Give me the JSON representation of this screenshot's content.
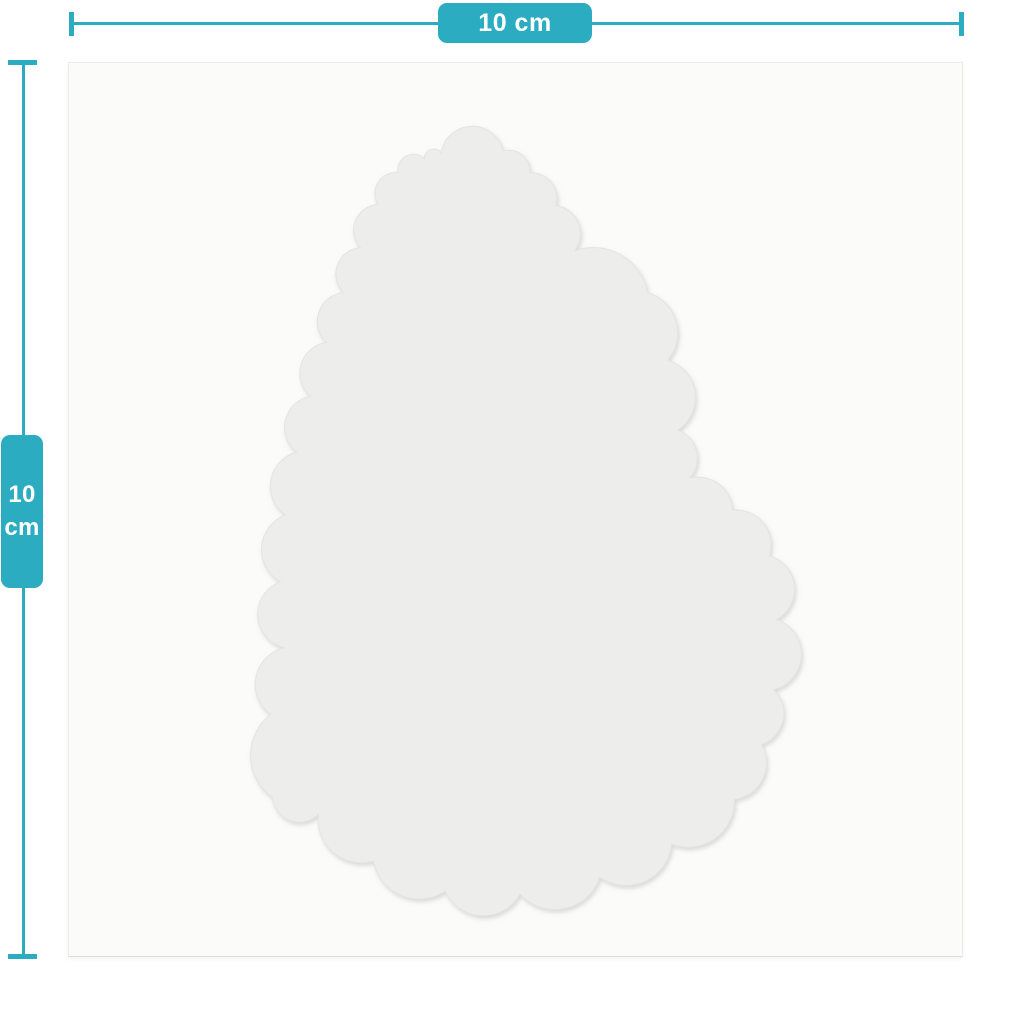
{
  "dimension_labels": {
    "horizontal": "10 cm",
    "vertical_value": "10",
    "vertical_unit": "cm"
  },
  "colors": {
    "accent": "#2bacc1",
    "canvas_background": "#fbfbfa",
    "sticker_fill": "#ededeb",
    "sticker_edge": "#e4e4e2",
    "label_text": "#ffffff"
  },
  "sticker_outline": {
    "bulge_default": 0.55,
    "points": [
      [
        373,
        90,
        0.5
      ],
      [
        435,
        88,
        0.51
      ],
      [
        462,
        110,
        0.62
      ],
      [
        488,
        143,
        0.62
      ],
      [
        507,
        188,
        0.58
      ],
      [
        580,
        230,
        0.66
      ],
      [
        600,
        298,
        0.6
      ],
      [
        610,
        368,
        0.55
      ],
      [
        622,
        416,
        0.6
      ],
      [
        665,
        448,
        0.65
      ],
      [
        702,
        494,
        0.6
      ],
      [
        709,
        558,
        0.54
      ],
      [
        706,
        628,
        0.52
      ],
      [
        694,
        683,
        0.58
      ],
      [
        667,
        738,
        0.6
      ],
      [
        604,
        783,
        0.6
      ],
      [
        532,
        816,
        0.58
      ],
      [
        452,
        833,
        0.58
      ],
      [
        377,
        830,
        0.56
      ],
      [
        305,
        800,
        0.6
      ],
      [
        250,
        753,
        0.6
      ],
      [
        204,
        736,
        0.55
      ],
      [
        202,
        653,
        0.62
      ],
      [
        216,
        586,
        0.55
      ],
      [
        212,
        520,
        0.52
      ],
      [
        217,
        453,
        0.55
      ],
      [
        228,
        390,
        0.55
      ],
      [
        242,
        334,
        0.55
      ],
      [
        258,
        280,
        0.55
      ],
      [
        275,
        230,
        0.55
      ],
      [
        292,
        185,
        0.55
      ],
      [
        310,
        142,
        0.55
      ],
      [
        330,
        110,
        0.55
      ],
      [
        356,
        96,
        0.52
      ]
    ]
  }
}
